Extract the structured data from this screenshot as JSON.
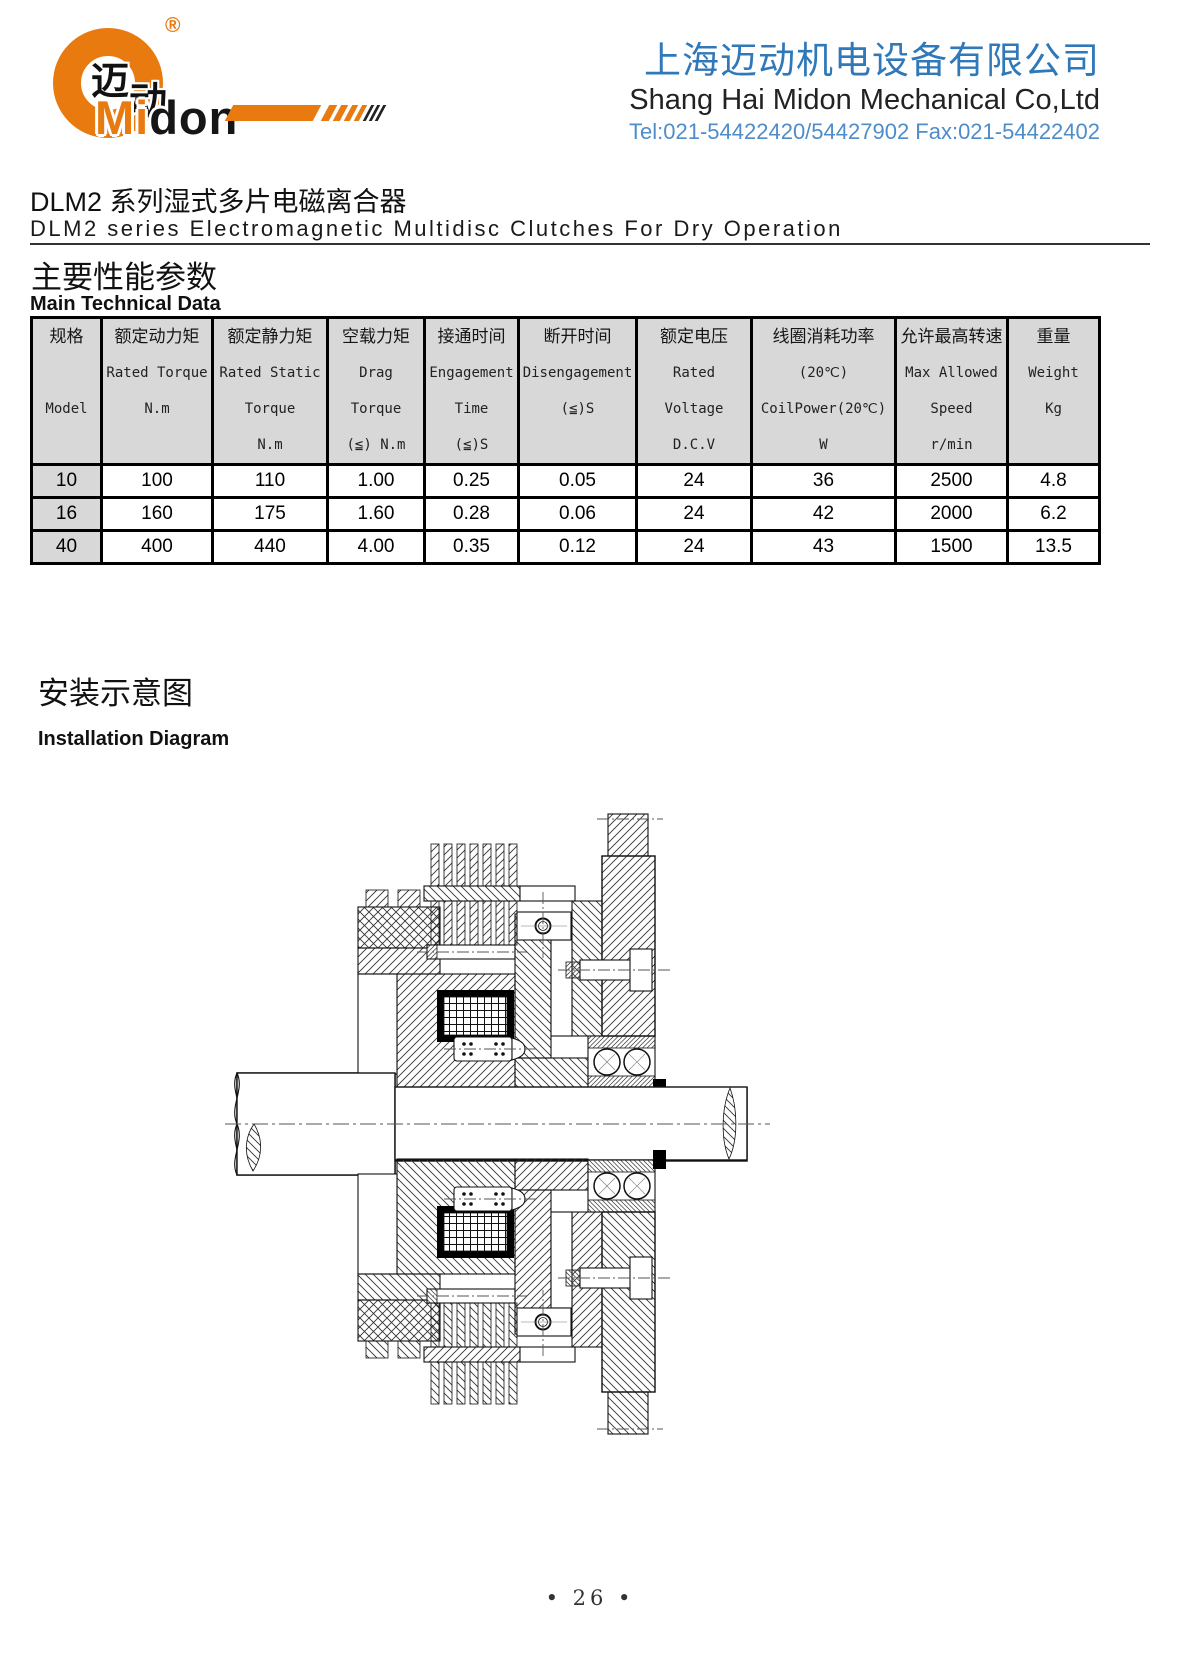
{
  "header": {
    "logo": {
      "cn1": "迈",
      "cn2": "动",
      "mi": "Mi",
      "don": "don",
      "registered": "®"
    },
    "company_cn": "上海迈动机电设备有限公司",
    "company_en": "Shang Hai Midon Mechanical Co,Ltd",
    "contact": "Tel:021-54422420/54427902 Fax:021-54422402",
    "accent_orange": "#e87a10",
    "accent_blue": "#2f78b9"
  },
  "title": {
    "cn": "DLM2 系列湿式多片电磁离合器",
    "en": "DLM2 series Electromagnetic Multidisc Clutches For Dry Operation"
  },
  "section_params": {
    "cn": "主要性能参数",
    "en": "Main Technical Data"
  },
  "table": {
    "columns": [
      {
        "l1": "规格",
        "l2": "",
        "l3": "Model",
        "l4": ""
      },
      {
        "l1": "额定动力矩",
        "l2": "Rated Torque",
        "l3": "N.m",
        "l4": ""
      },
      {
        "l1": "额定静力矩",
        "l2": "Rated Static",
        "l3": "Torque",
        "l4": "N.m"
      },
      {
        "l1": "空载力矩",
        "l2": "Drag",
        "l3": "Torque",
        "l4": "(≦) N.m"
      },
      {
        "l1": "接通时间",
        "l2": "Engagement",
        "l3": "Time",
        "l4": "(≦)S"
      },
      {
        "l1": "断开时间",
        "l2": "Disengagement",
        "l3": "(≦)S",
        "l4": ""
      },
      {
        "l1": "额定电压",
        "l2": "Rated",
        "l3": "Voltage",
        "l4": "D.C.V"
      },
      {
        "l1": "线圈消耗功率",
        "l2": "(20℃)",
        "l3": "CoilPower(20℃)",
        "l4": "W"
      },
      {
        "l1": "允许最高转速",
        "l2": "Max Allowed",
        "l3": "Speed",
        "l4": "r/min"
      },
      {
        "l1": "重量",
        "l2": "Weight",
        "l3": "Kg",
        "l4": ""
      }
    ],
    "rows": [
      [
        "10",
        "100",
        "110",
        "1.00",
        "0.25",
        "0.05",
        "24",
        "36",
        "2500",
        "4.8"
      ],
      [
        "16",
        "160",
        "175",
        "1.60",
        "0.28",
        "0.06",
        "24",
        "42",
        "2000",
        "6.2"
      ],
      [
        "40",
        "400",
        "440",
        "4.00",
        "0.35",
        "0.12",
        "24",
        "43",
        "1500",
        "13.5"
      ]
    ]
  },
  "section_install": {
    "cn": "安装示意图",
    "en": "Installation Diagram"
  },
  "footer": {
    "page": "• 26 •"
  }
}
